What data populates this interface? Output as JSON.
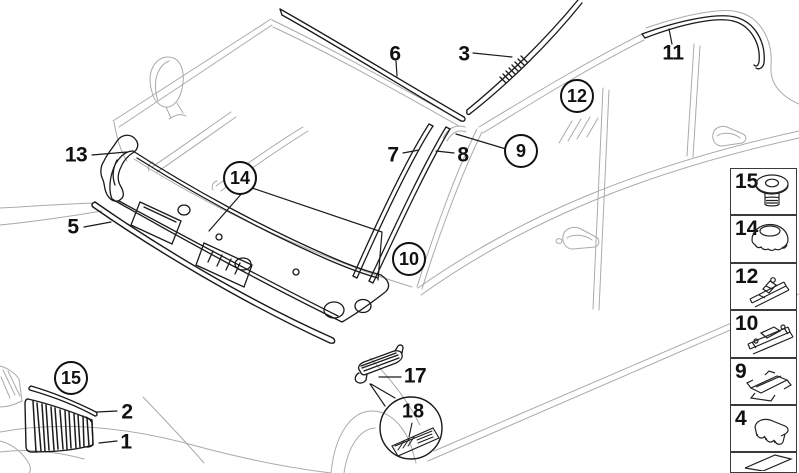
{
  "diagram": {
    "type": "vehicle-parts-exploded-diagram",
    "colors": {
      "background": "#ffffff",
      "part_line": "#1a1a1a",
      "body_line": "#aaaaaa",
      "text": "#111111"
    }
  },
  "callouts": {
    "c1": "1",
    "c2": "2",
    "c3": "3",
    "c5": "5",
    "c6": "6",
    "c7": "7",
    "c8": "8",
    "c9": "9",
    "c10": "10",
    "c11": "11",
    "c12": "12",
    "c13": "13",
    "c14": "14",
    "c15": "15",
    "c17": "17",
    "c18": "18"
  },
  "sidebar": {
    "items": [
      {
        "label": "15",
        "icon": "grommet-fastener-icon"
      },
      {
        "label": "14",
        "icon": "cap-fastener-icon"
      },
      {
        "label": "12",
        "icon": "molding-clip-icon"
      },
      {
        "label": "10",
        "icon": "rail-clip-icon"
      },
      {
        "label": "9",
        "icon": "clamp-bracket-icon"
      },
      {
        "label": "4",
        "icon": "retainer-clip-icon"
      },
      {
        "label": "",
        "icon": "trim-plate-icon"
      }
    ]
  }
}
